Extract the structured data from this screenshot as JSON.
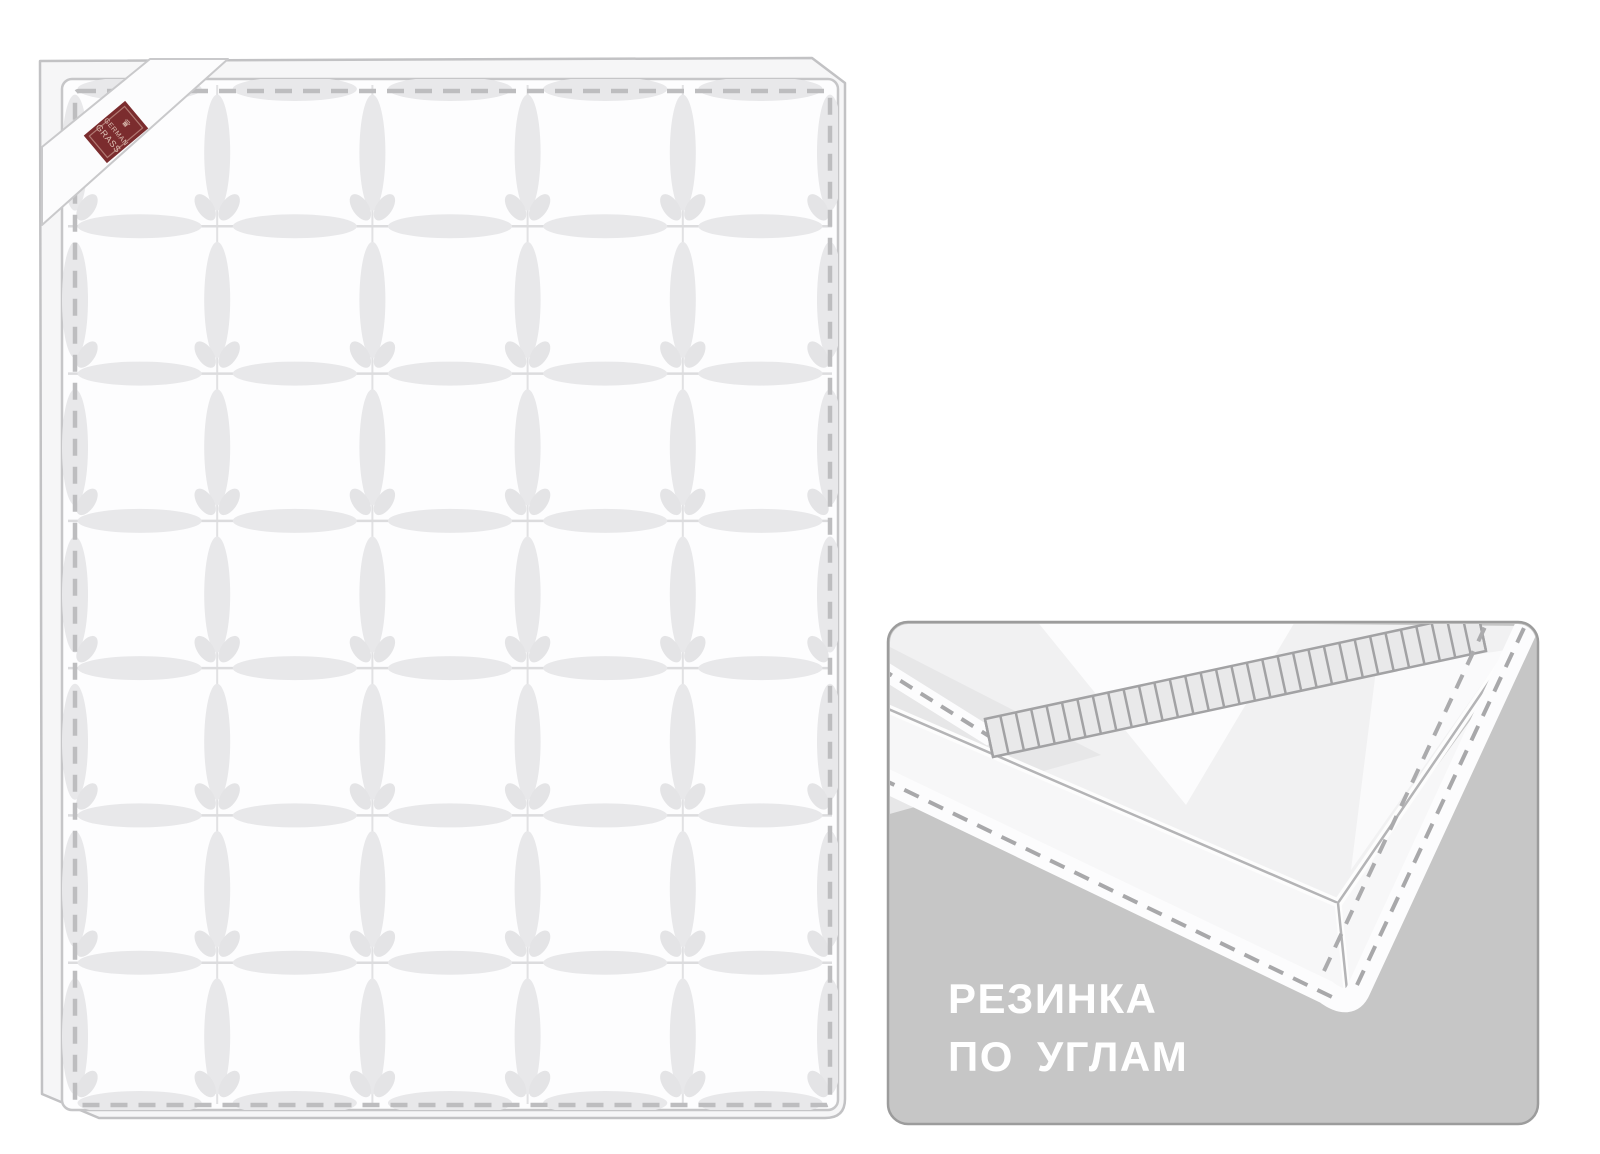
{
  "page": {
    "background_color": "#ffffff",
    "description_line1": "Quilted mattress pad illustration",
    "description_line2": "Corner elastic detail inset"
  },
  "mattress": {
    "label_brand_line1": "GERMAN",
    "label_brand_line2": "GRASS",
    "label_crest_icon": "♛",
    "label_color": "#7b2c2e",
    "label_text_color": "#dcc0b4",
    "grid_columns": 5,
    "grid_rows": 7,
    "fabric_color": "#fdfdfe",
    "side_band_color": "#f6f6f7",
    "outline_color": "#c2c2c4",
    "face_edge_color": "#c6c6c8",
    "stitch_color": "#bdbdbf",
    "grid_line_color": "#dcdcde",
    "quilt_shade_color": "#e8e8ea",
    "ear_color": "#e4e4e6"
  },
  "inset": {
    "caption_line1": "РЕЗИНКА",
    "caption_line2": "ПО УГЛАМ",
    "caption_color": "#ffffff",
    "panel_color": "#c6c6c6",
    "panel_border_color": "#9c9c9c",
    "fabric_color": "#f1f1f2",
    "side_face_color": "#f7f7f8",
    "band_color": "#fcfcfd",
    "stitch_dash_color": "#a8a8aa",
    "seam_line_color": "#b4b4b6",
    "elastic_color": "#e9e9ea",
    "elastic_rib_color": "#a2a2a4",
    "rib_count": 32
  }
}
